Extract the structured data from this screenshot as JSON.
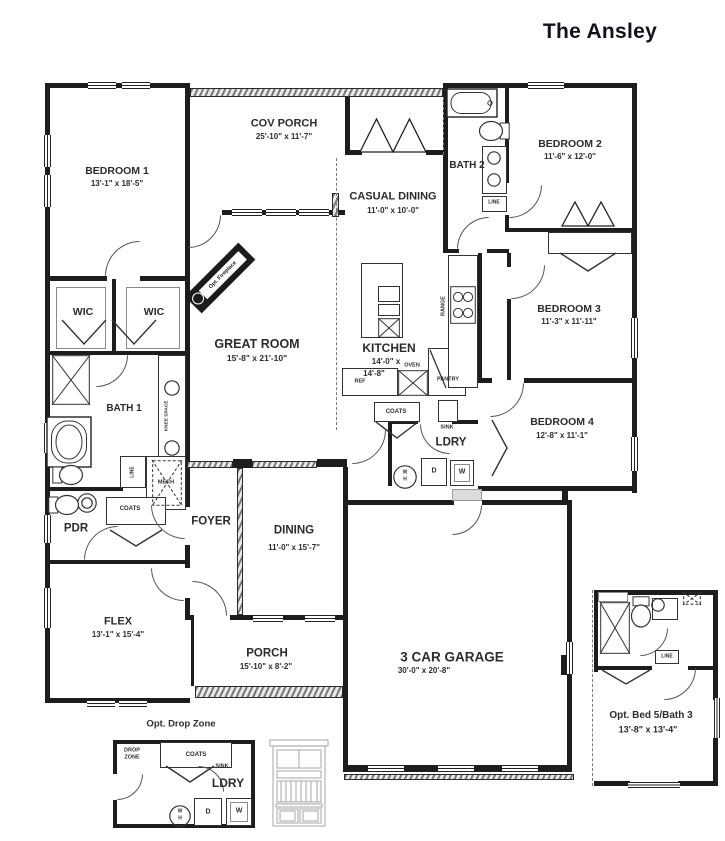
{
  "title": "The Ansley",
  "rooms": {
    "bedroom1": {
      "name": "BEDROOM 1",
      "dims": "13'-1\" x 18'-5\""
    },
    "cov_porch": {
      "name": "COV PORCH",
      "dims": "25'-10\" x 11'-7\""
    },
    "casual_dining": {
      "name": "CASUAL DINING",
      "dims": "11'-0\" x 10'-0\""
    },
    "bath2": {
      "name": "BATH 2"
    },
    "bedroom2": {
      "name": "BEDROOM 2",
      "dims": "11'-6\" x 12'-0\""
    },
    "bedroom3": {
      "name": "BEDROOM 3",
      "dims": "11'-3\" x 11'-11\""
    },
    "bedroom4": {
      "name": "BEDROOM 4",
      "dims": "12'-8\" x 11'-1\""
    },
    "great_room": {
      "name": "GREAT ROOM",
      "dims": "15'-8\" x 21'-10\""
    },
    "kitchen": {
      "name": "KITCHEN",
      "dims1": "14'-0\" x",
      "dims2": "14'-8\""
    },
    "wic": {
      "name": "WIC"
    },
    "bath1": {
      "name": "BATH 1"
    },
    "pdr": {
      "name": "PDR"
    },
    "ldry": {
      "name": "LDRY"
    },
    "foyer": {
      "name": "FOYER"
    },
    "dining": {
      "name": "DINING",
      "dims": "11'-0\" x 15'-7\""
    },
    "flex": {
      "name": "FLEX",
      "dims": "13'-1\" x 15'-4\""
    },
    "porch": {
      "name": "PORCH",
      "dims": "15'-10\" x 8'-2\""
    },
    "garage": {
      "name": "3 CAR GARAGE",
      "dims": "30'-0\" x 20'-8\""
    }
  },
  "fx": {
    "ref": "REF",
    "oven": "OVEN",
    "pantry": "PANTRY",
    "range": "RANGE",
    "coats": "COATS",
    "sink": "SINK",
    "line": "LINE",
    "mech": "MECH",
    "washer": "W",
    "dryer": "D",
    "wh1": "W",
    "wh2": "H",
    "knee": "KNEE SPACE",
    "fireplace": "Opt. Fireplace"
  },
  "insetA": {
    "title": "Opt. Drop Zone",
    "drop1": "DROP",
    "drop2": "ZONE"
  },
  "insetB": {
    "title": "Opt. Bed 5/Bath 3",
    "dims": "13'-8\" x 13'-4\""
  }
}
